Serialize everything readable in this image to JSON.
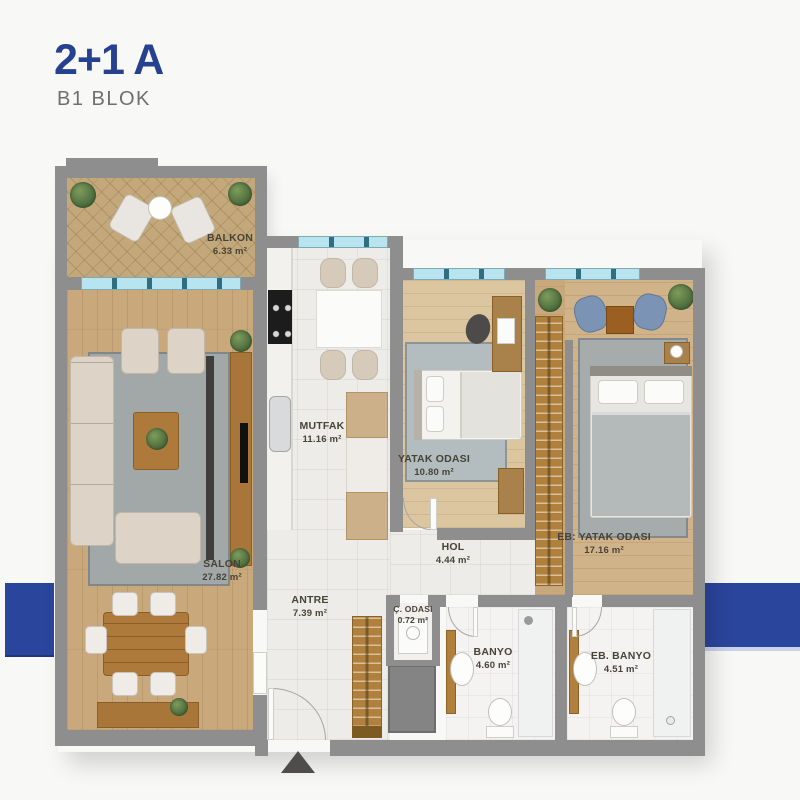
{
  "header": {
    "title": "2+1 A",
    "subtitle": "B1 BLOK"
  },
  "colors": {
    "accent_blue": "#26418f",
    "side_band_blue": "#2a459c",
    "wall_gray": "#8e8e8e",
    "window_glass": "#b7e4ef",
    "wood_floor": "#c9a97c",
    "tile_floor": "#edece8",
    "label_text": "#474337"
  },
  "rooms": [
    {
      "name": "BALKON",
      "area": "6.33 m²"
    },
    {
      "name": "SALON",
      "area": "27.82 m²"
    },
    {
      "name": "MUTFAK",
      "area": "11.16 m²"
    },
    {
      "name": "YATAK ODASI",
      "area": "10.80 m²"
    },
    {
      "name": "EB: YATAK ODASI",
      "area": "17.16 m²"
    },
    {
      "name": "HOL",
      "area": "4.44 m²"
    },
    {
      "name": "ANTRE",
      "area": "7.39 m²"
    },
    {
      "name": "Ç. ODASI",
      "area": "0.72 m²"
    },
    {
      "name": "BANYO",
      "area": "4.60 m²"
    },
    {
      "name": "EB. BANYO",
      "area": "4.51 m²"
    }
  ]
}
